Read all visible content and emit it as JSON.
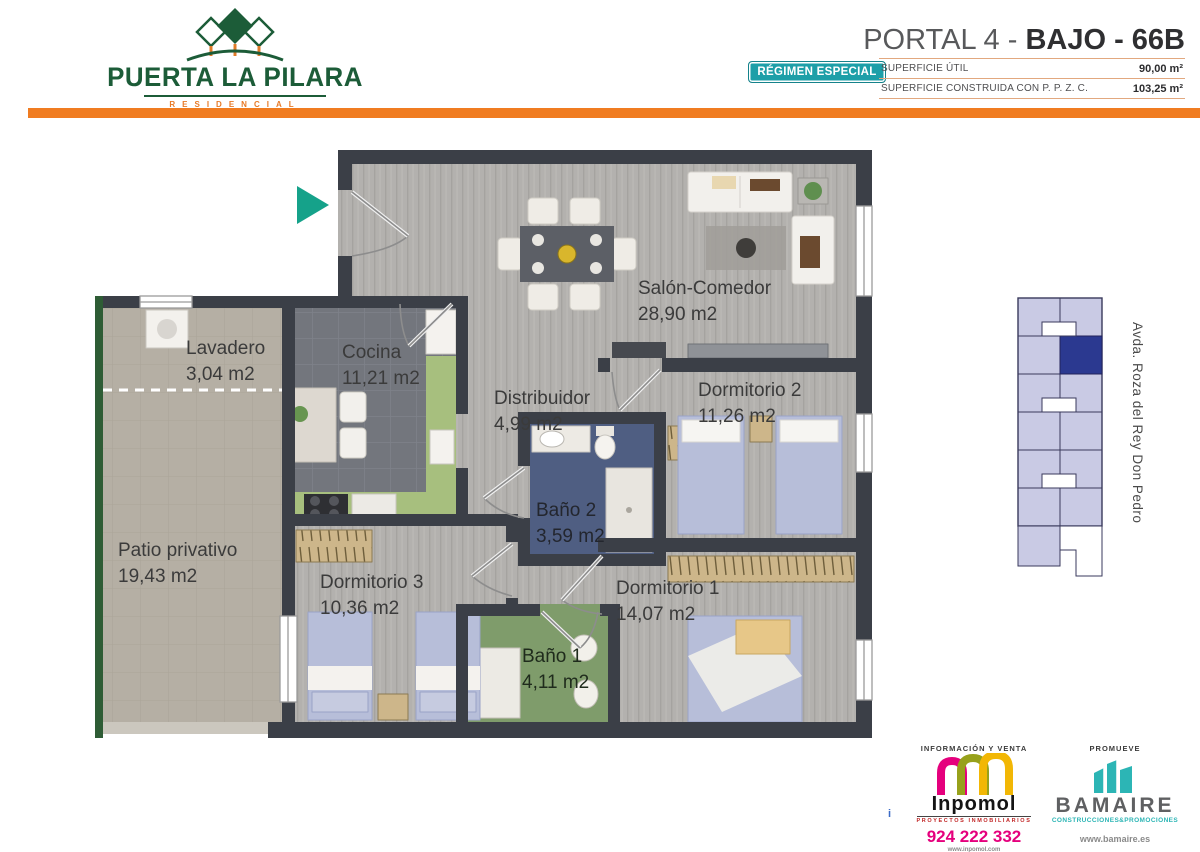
{
  "header": {
    "brand": {
      "name": "PUERTA LA PILARA",
      "subtitle": "RESIDENCIAL"
    },
    "plan_title": {
      "prefix": "PORTAL 4 - ",
      "bold": "BAJO - 66B"
    },
    "badge": "RÉGIMEN ESPECIAL",
    "specs": [
      {
        "label": "SUPERFICIE ÚTIL",
        "value": "90,00 m²"
      },
      {
        "label": "SUPERFICIE  CONSTRUIDA CON P. P. Z. C.",
        "value": "103,25 m²"
      }
    ]
  },
  "floorplan": {
    "rooms": [
      {
        "name": "Salón-Comedor",
        "area": "28,90 m2"
      },
      {
        "name": "Lavadero",
        "area": "3,04 m2"
      },
      {
        "name": "Cocina",
        "area": "11,21 m2"
      },
      {
        "name": "Distribuidor",
        "area": "4,99 m2"
      },
      {
        "name": "Dormitorio 2",
        "area": "11,26 m2"
      },
      {
        "name": "Baño 2",
        "area": "3,59 m2"
      },
      {
        "name": "Patio privativo",
        "area": "19,43 m2"
      },
      {
        "name": "Dormitorio 3",
        "area": "10,36 m2"
      },
      {
        "name": "Dormitorio 1",
        "area": "14,07 m2"
      },
      {
        "name": "Baño 1",
        "area": "4,11 m2"
      }
    ],
    "street_label": "Avda. Roza del Rey Don Pedro"
  },
  "footer": {
    "sales": {
      "heading": "INFORMACIÓN Y VENTA",
      "brand": "Inpomol",
      "tagline": "PROYECTOS INMOBILIARIOS",
      "phone": "924 222 332",
      "website": "www.inpomol.com"
    },
    "developer": {
      "heading": "PROMUEVE",
      "brand": "BAMAIRE",
      "tagline": "CONSTRUCCIONES&PROMOCIONES",
      "website": "www.bamaire.es"
    },
    "info_marker": "i"
  },
  "colors": {
    "accent_orange": "#f07c21",
    "brand_green": "#1c5c38",
    "badge_teal": "#1d9fa8",
    "entrance_arrow_teal": "#15a28a",
    "highlighted_unit_blue": "#2b3990",
    "minimap_unit_lavender": "#c9cae4",
    "inpomol_magenta": "#e5007d",
    "bamaire_teal": "#2cb5b5"
  }
}
